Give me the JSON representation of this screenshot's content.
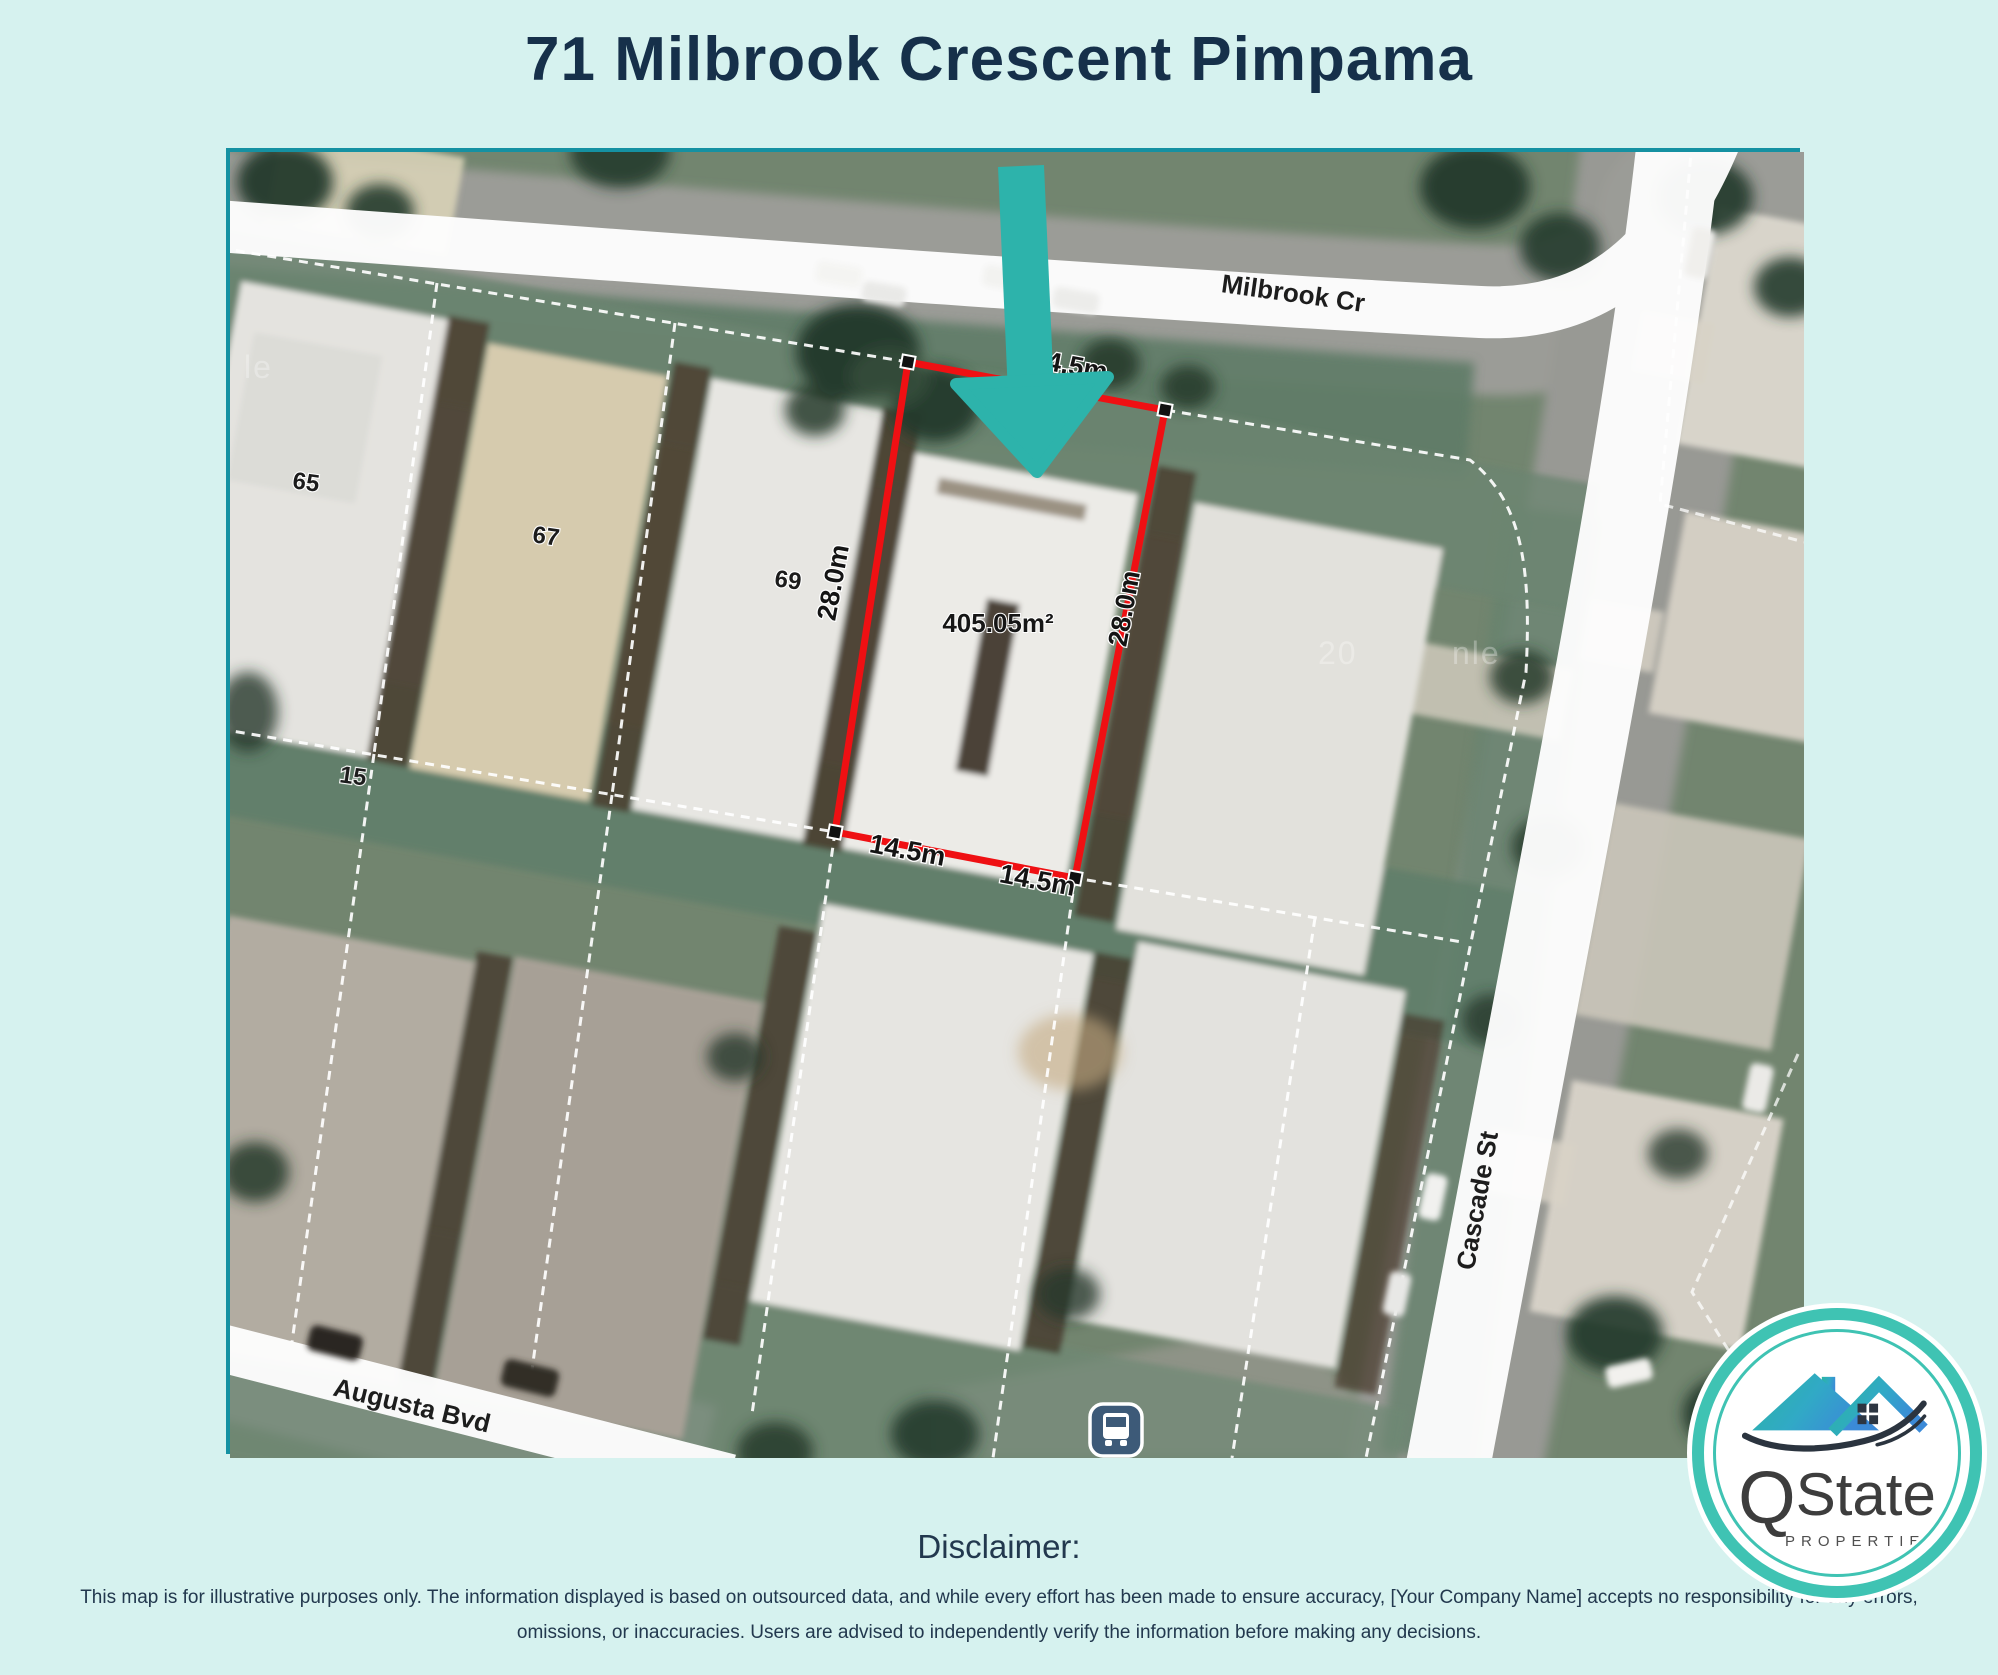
{
  "page": {
    "title": "71 Milbrook Crescent Pimpama"
  },
  "map": {
    "street_labels": {
      "milbrook": "Milbrook Cr",
      "cascade": "Cascade St",
      "augusta": "Augusta Bvd"
    },
    "parcel": {
      "area": "405.05m²",
      "dim_top": "14.5m",
      "dim_left": "28.0m",
      "dim_right": "28.0m",
      "dim_bottom_left": "14.5m",
      "dim_bottom_right": "14.5m"
    },
    "house_numbers": {
      "n65": "65",
      "n67": "67",
      "n69": "69",
      "n15": "15"
    },
    "watermark_fragments": {
      "left": "le",
      "mid": "20",
      "right": "nle"
    },
    "icons": {
      "bus_stop": "bus-stop-icon",
      "pointer": "down-arrow-marker"
    }
  },
  "logo": {
    "name_q": "Q",
    "name_rest": "State",
    "tagline": "PROPERTIES"
  },
  "disclaimer": {
    "heading": "Disclaimer:",
    "body": "This map is for illustrative purposes only. The information displayed is based on outsourced data, and while every effort has been made to ensure accuracy, [Your Company Name] accepts no responsibility for any errors, omissions, or inaccuracies. Users are advised to independently verify the information before making any decisions."
  },
  "colors": {
    "background": "#d6f2ef",
    "title_navy": "#16304a",
    "map_border_teal": "#1591a2",
    "arrow_teal": "#2db3ab",
    "parcel_red": "#ef1013",
    "logo_ring_teal": "#3fc3b3",
    "bus_icon_navy": "#3d5a78"
  }
}
